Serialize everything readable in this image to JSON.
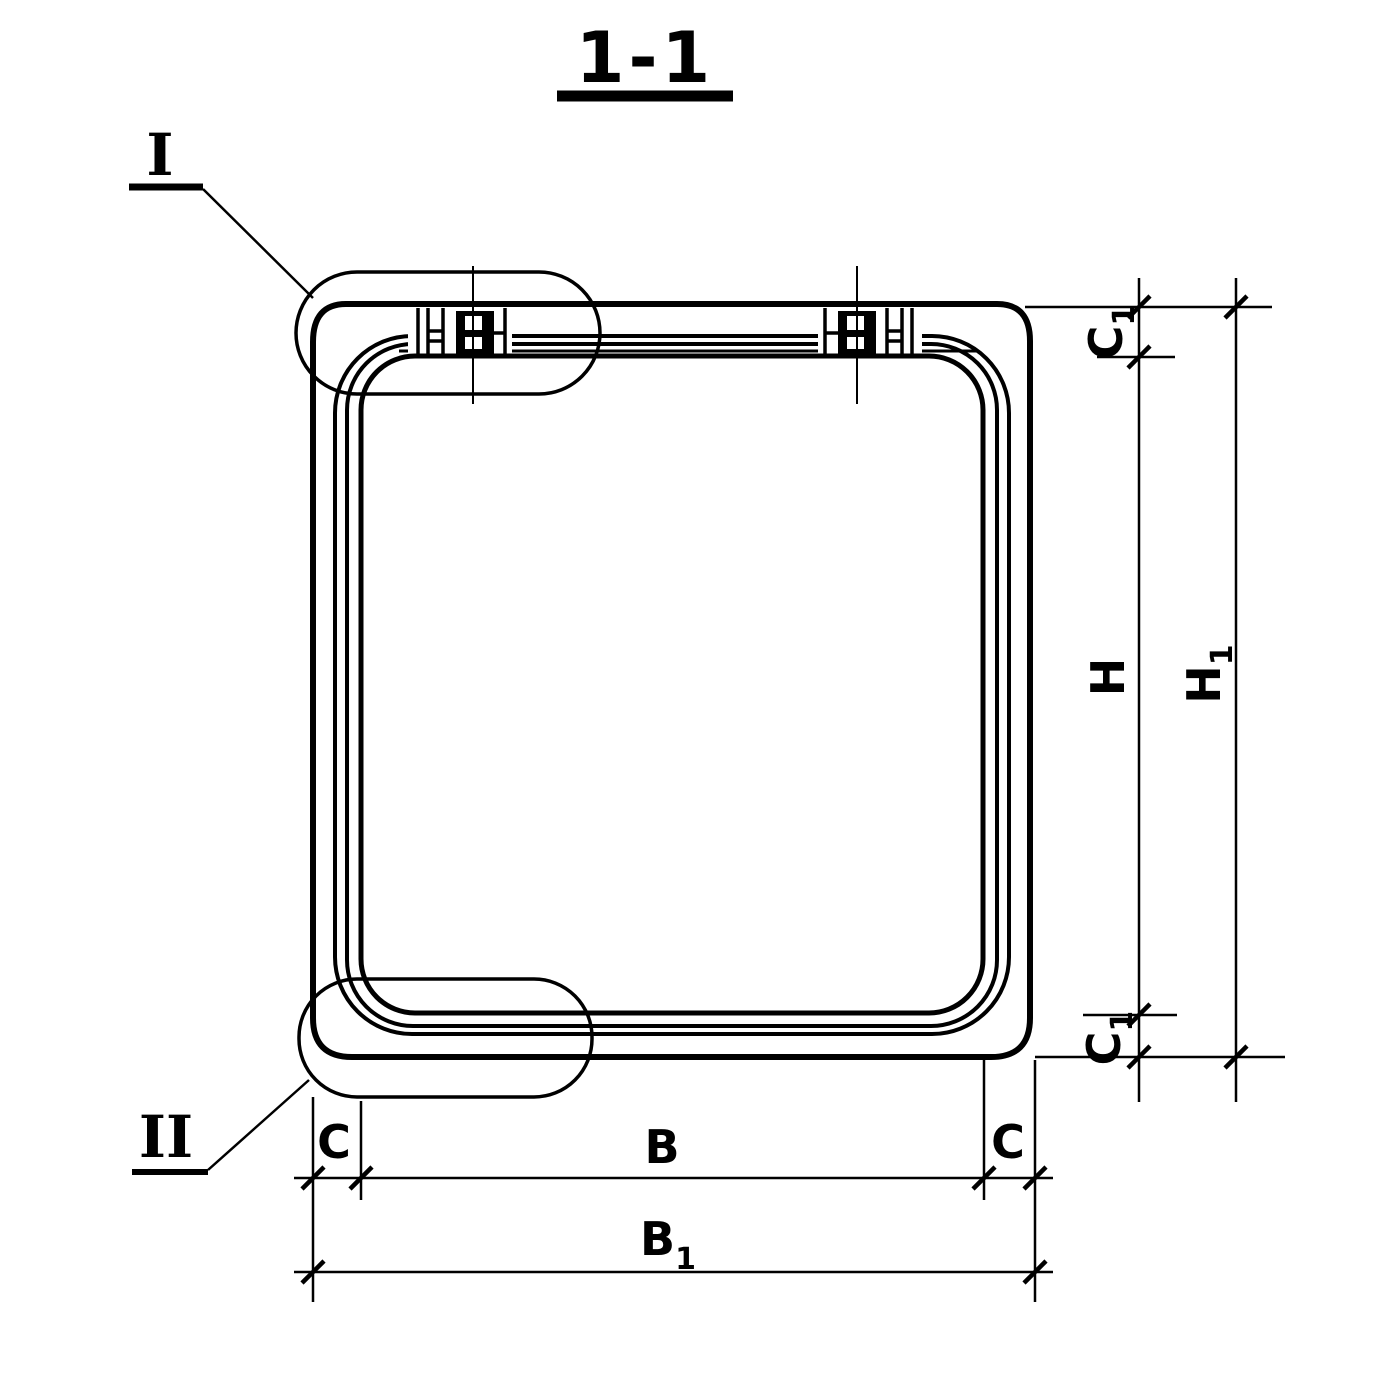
{
  "page": {
    "paper_color": "#ffffff",
    "ink_color": "#000000"
  },
  "title": {
    "text": "1-1"
  },
  "callouts": {
    "detail_one": "I",
    "detail_two": "II"
  },
  "dims": {
    "c1_top": {
      "base": "C",
      "sub": "1"
    },
    "h": {
      "base": "H",
      "sub": ""
    },
    "h1": {
      "base": "H",
      "sub": "1"
    },
    "c1_bottom": {
      "base": "C",
      "sub": "1"
    },
    "c_left": {
      "base": "C",
      "sub": ""
    },
    "b": {
      "base": "B",
      "sub": ""
    },
    "c_right": {
      "base": "C",
      "sub": ""
    },
    "b1": {
      "base": "B",
      "sub": "1"
    }
  }
}
